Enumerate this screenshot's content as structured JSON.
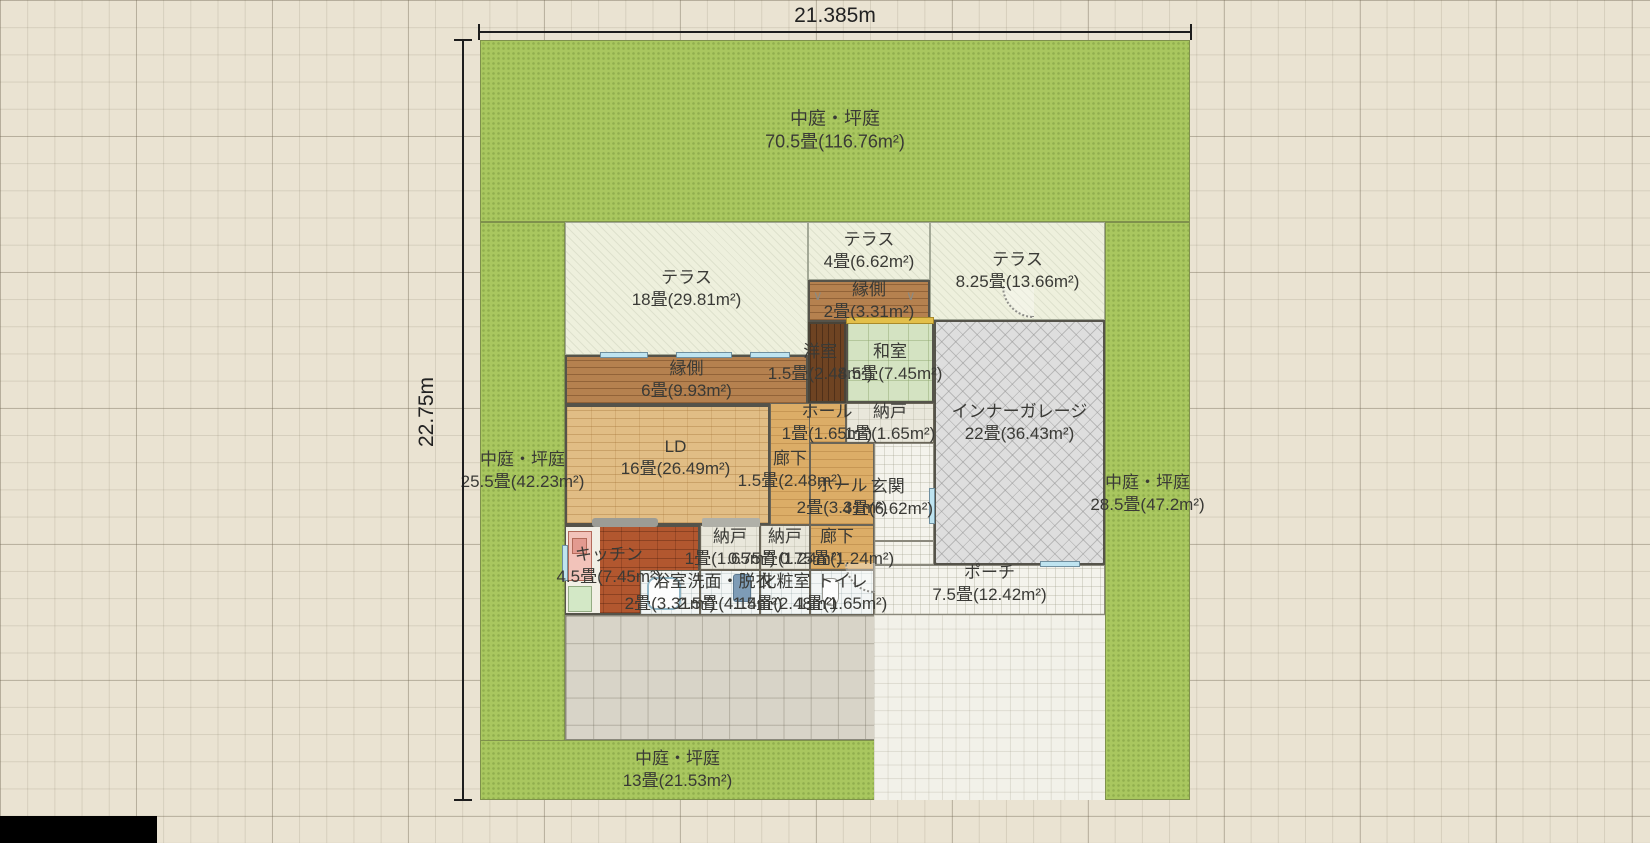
{
  "plan": {
    "dimensions": {
      "top": "21.385m",
      "left": "22.75m"
    },
    "rooms": {
      "garden_top": {
        "name": "中庭・坪庭",
        "size": "70.5畳(116.76m²)"
      },
      "garden_left": {
        "name": "中庭・坪庭",
        "size": "25.5畳(42.23m²)"
      },
      "garden_right": {
        "name": "中庭・坪庭",
        "size": "28.5畳(47.2m²)"
      },
      "garden_bottom": {
        "name": "中庭・坪庭",
        "size": "13畳(21.53m²)"
      },
      "terrace_large": {
        "name": "テラス",
        "size": "18畳(29.81m²)"
      },
      "terrace_small": {
        "name": "テラス",
        "size": "4畳(6.62m²)"
      },
      "terrace_right": {
        "name": "テラス",
        "size": "8.25畳(13.66m²)"
      },
      "engawa_small": {
        "name": "縁側",
        "size": "2畳(3.31m²)"
      },
      "engawa_large": {
        "name": "縁側",
        "size": "6畳(9.93m²)"
      },
      "youshitsu": {
        "name": "洋室",
        "size": "1.5畳(2.48m²)"
      },
      "washitsu": {
        "name": "和室",
        "size": "4.5畳(7.45m²)"
      },
      "hall_small": {
        "name": "ホール",
        "size": "1畳(1.65m²)"
      },
      "nando_1": {
        "name": "納戸",
        "size": "1畳(1.65m²)"
      },
      "garage": {
        "name": "インナーガレージ",
        "size": "22畳(36.43m²)"
      },
      "ld": {
        "name": "LD",
        "size": "16畳(26.49m²)"
      },
      "rouka_main": {
        "name": "廊下",
        "size": "1.5畳(2.48m²)"
      },
      "hall_main": {
        "name": "ホール",
        "size": "2畳(3.31m²)"
      },
      "genkan": {
        "name": "玄関",
        "size": "4畳(6.62m²)"
      },
      "kitchen": {
        "name": "キッチン",
        "size": "4.5畳(7.45m²)"
      },
      "nando_2": {
        "name": "納戸",
        "size": "1畳(1.65m²)"
      },
      "nando_3": {
        "name": "納戸",
        "size": "0.75畳(1.24m²)"
      },
      "rouka_small": {
        "name": "廊下",
        "size": "0.75畳(1.24m²)"
      },
      "bath": {
        "name": "浴室",
        "size": "2畳(3.31m²)"
      },
      "senmen": {
        "name": "洗面・脱衣",
        "size": "2.5畳(4.14m²)"
      },
      "keshou": {
        "name": "化粧室",
        "size": "1.5畳(2.48m²)"
      },
      "toilet": {
        "name": "トイレ",
        "size": "1畳(1.65m²)"
      },
      "porch": {
        "name": "ポーチ",
        "size": "7.5畳(12.42m²)"
      }
    }
  }
}
